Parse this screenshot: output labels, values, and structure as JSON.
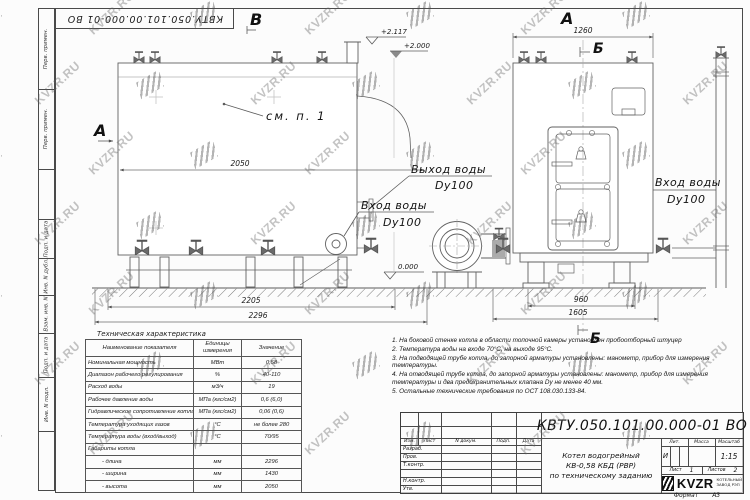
{
  "watermark": {
    "text": "KVZR.RU"
  },
  "frame": {
    "top_stamp": "КВТУ.050.101.00.000-01 ВО",
    "side_labels": [
      "Перв. примен.",
      "Перв. примен.",
      "Подп. и дата",
      "Инв. N дубл.",
      "Взам. инв. N",
      "Подп. и дата",
      "Инв. N подл."
    ]
  },
  "drawing": {
    "view_a_left": "А",
    "view_b_top": "В",
    "view_a_right": "А",
    "view_b_right_top": "Б",
    "view_b_right_bottom": "Б",
    "callout_see_item": "см. п. 1",
    "dim_2050": "2050",
    "dim_2205": "2205",
    "dim_2296": "2296",
    "dim_1260": "1260",
    "dim_960": "960",
    "dim_1605": "1605",
    "elev_2117": "+2.117",
    "elev_2000": "+2.000",
    "elev_0": "0.000",
    "outlet_label_1": "Выход воды",
    "outlet_label_2": "Dy100",
    "inlet_left_1": "Вход воды",
    "inlet_left_2": "Dy100",
    "inlet_right_1": "Вход воды",
    "inlet_right_2": "Dy100"
  },
  "spec_table": {
    "title": "Техническая характеристика",
    "headers": [
      "Наименование показателя",
      "Единицы измерения",
      "Значение"
    ],
    "rows": [
      [
        "Номинальная мощность",
        "МВт",
        "0,58"
      ],
      [
        "Диапазон рабочего регулирования",
        "%",
        "40-110"
      ],
      [
        "Расход воды",
        "м3/ч",
        "19"
      ],
      [
        "Рабочее давление воды",
        "МПа (кгс/см2)",
        "0,6 (6,0)"
      ],
      [
        "Гидравлическое сопротивление котла",
        "МПа (кгс/см2)",
        "0,06 (0,6)"
      ],
      [
        "Температура уходящих газов",
        "°С",
        "не более 280"
      ],
      [
        "Температура воды (вход/выход)",
        "°С",
        "70/95"
      ],
      [
        "Габариты котла",
        "",
        ""
      ],
      [
        "- длина",
        "мм",
        "2296"
      ],
      [
        "- ширина",
        "мм",
        "1430"
      ],
      [
        "- высота",
        "мм",
        "2050"
      ]
    ]
  },
  "notes": [
    "1. На боковой стенке котла в области топочной камеры установлен пробоотборный штуцер",
    "2. Температура воды на входе 70°С, на выходе 95°С.",
    "3. На подводящей трубе котла, до запорной арматуры установлены: манометр, прибор для измерения температуры.",
    "4. На отводящей трубе котла, до запорной арматуры установлены: манометр, прибор для измерения температуры и два предохранительных клапана Dy не менее 40 мм.",
    "5. Остальные технические требования по ОСТ 108.030.133-84."
  ],
  "title_block": {
    "code": "КВТУ.050.101.00.000-01 ВО",
    "rev_headers": [
      "Изм.",
      "Лист",
      "N докум.",
      "Подп.",
      "Дата"
    ],
    "roles": [
      "Разраб.",
      "Пров.",
      "Т.контр.",
      "Н.контр.",
      "Утв."
    ],
    "name_line1": "Котел водогрейный",
    "name_line2": "КВ-0,58 КБД (РВР)",
    "name_line3": "по техническому заданию",
    "lit_header": "Лит.",
    "mass_header": "Масса",
    "scale_header": "Масштаб",
    "lit_value": "И",
    "scale_value": "1:15",
    "sheet_label": "Лист",
    "sheet_value": "1",
    "sheets_label": "Листов",
    "sheets_value": "2",
    "logo_text": "KVZR",
    "company_line1": "КОТЕЛЬНЫЙ",
    "company_line2": "ЗАВОД РЭП",
    "format_label": "Формат",
    "format_value": "А3"
  }
}
